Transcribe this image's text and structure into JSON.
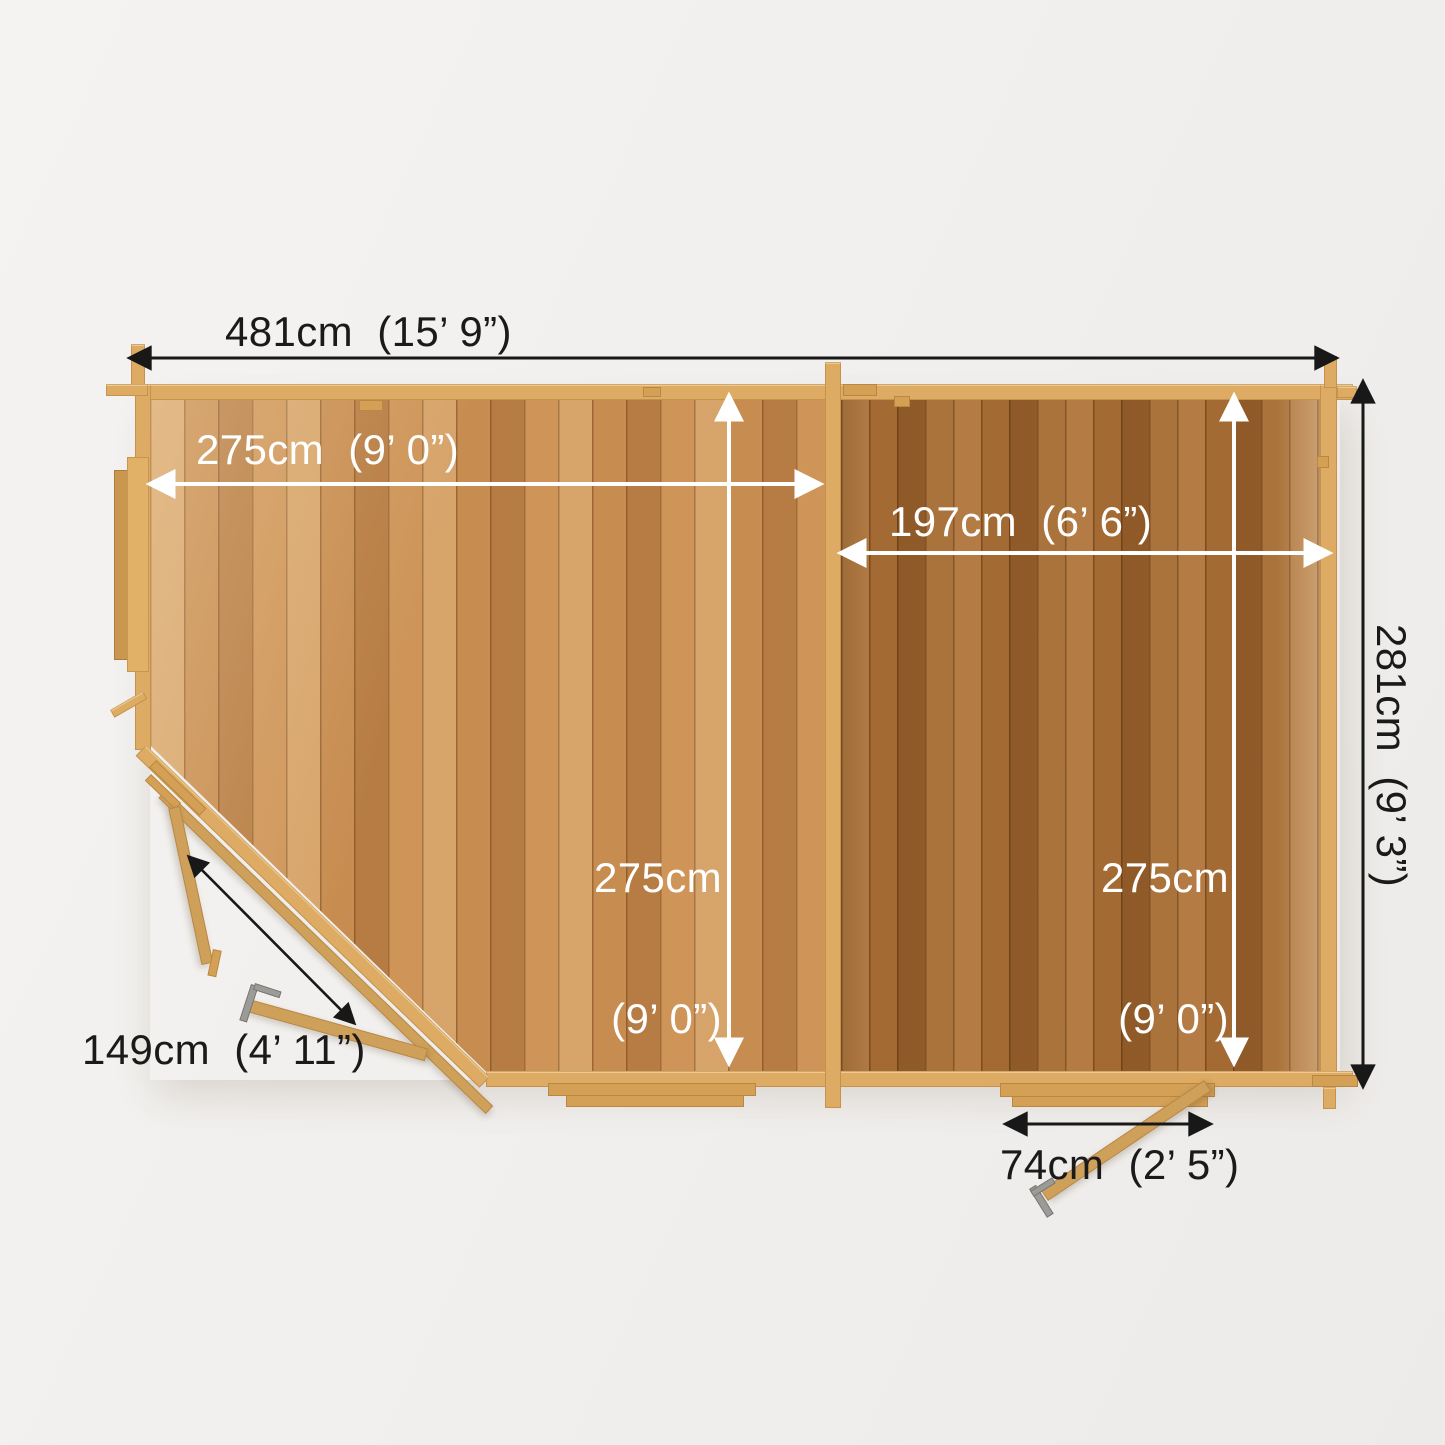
{
  "page": {
    "background": "#f2f1ee"
  },
  "diagram": {
    "title": "Top-down floor plan of a two-room corner log cabin with dimensions",
    "dimensions": {
      "overall_width": "481cm  (15’ 9”)",
      "overall_depth": "281cm  (9’ 3”)",
      "main_room_width": "275cm  (9’ 0”)",
      "main_room_depth_cm": "275cm",
      "main_room_depth_ft": "(9’ 0”)",
      "side_room_width": "197cm  (6’ 6”)",
      "side_room_depth_cm": "275cm",
      "side_room_depth_ft": "(9’ 0”)",
      "corner_door_width": "149cm  (4’ 11”)",
      "side_door_width": "74cm  (2’ 5”)"
    },
    "colors": {
      "background": "#f2f1ee",
      "wall_wood": "#ddab63",
      "floor_main_room": "#c78c50",
      "floor_side_room": "#a46a33",
      "dimension_text_dark": "#1a1a1a",
      "dimension_text_light": "#ffffff",
      "door_hardware": "#9b9b97"
    }
  }
}
